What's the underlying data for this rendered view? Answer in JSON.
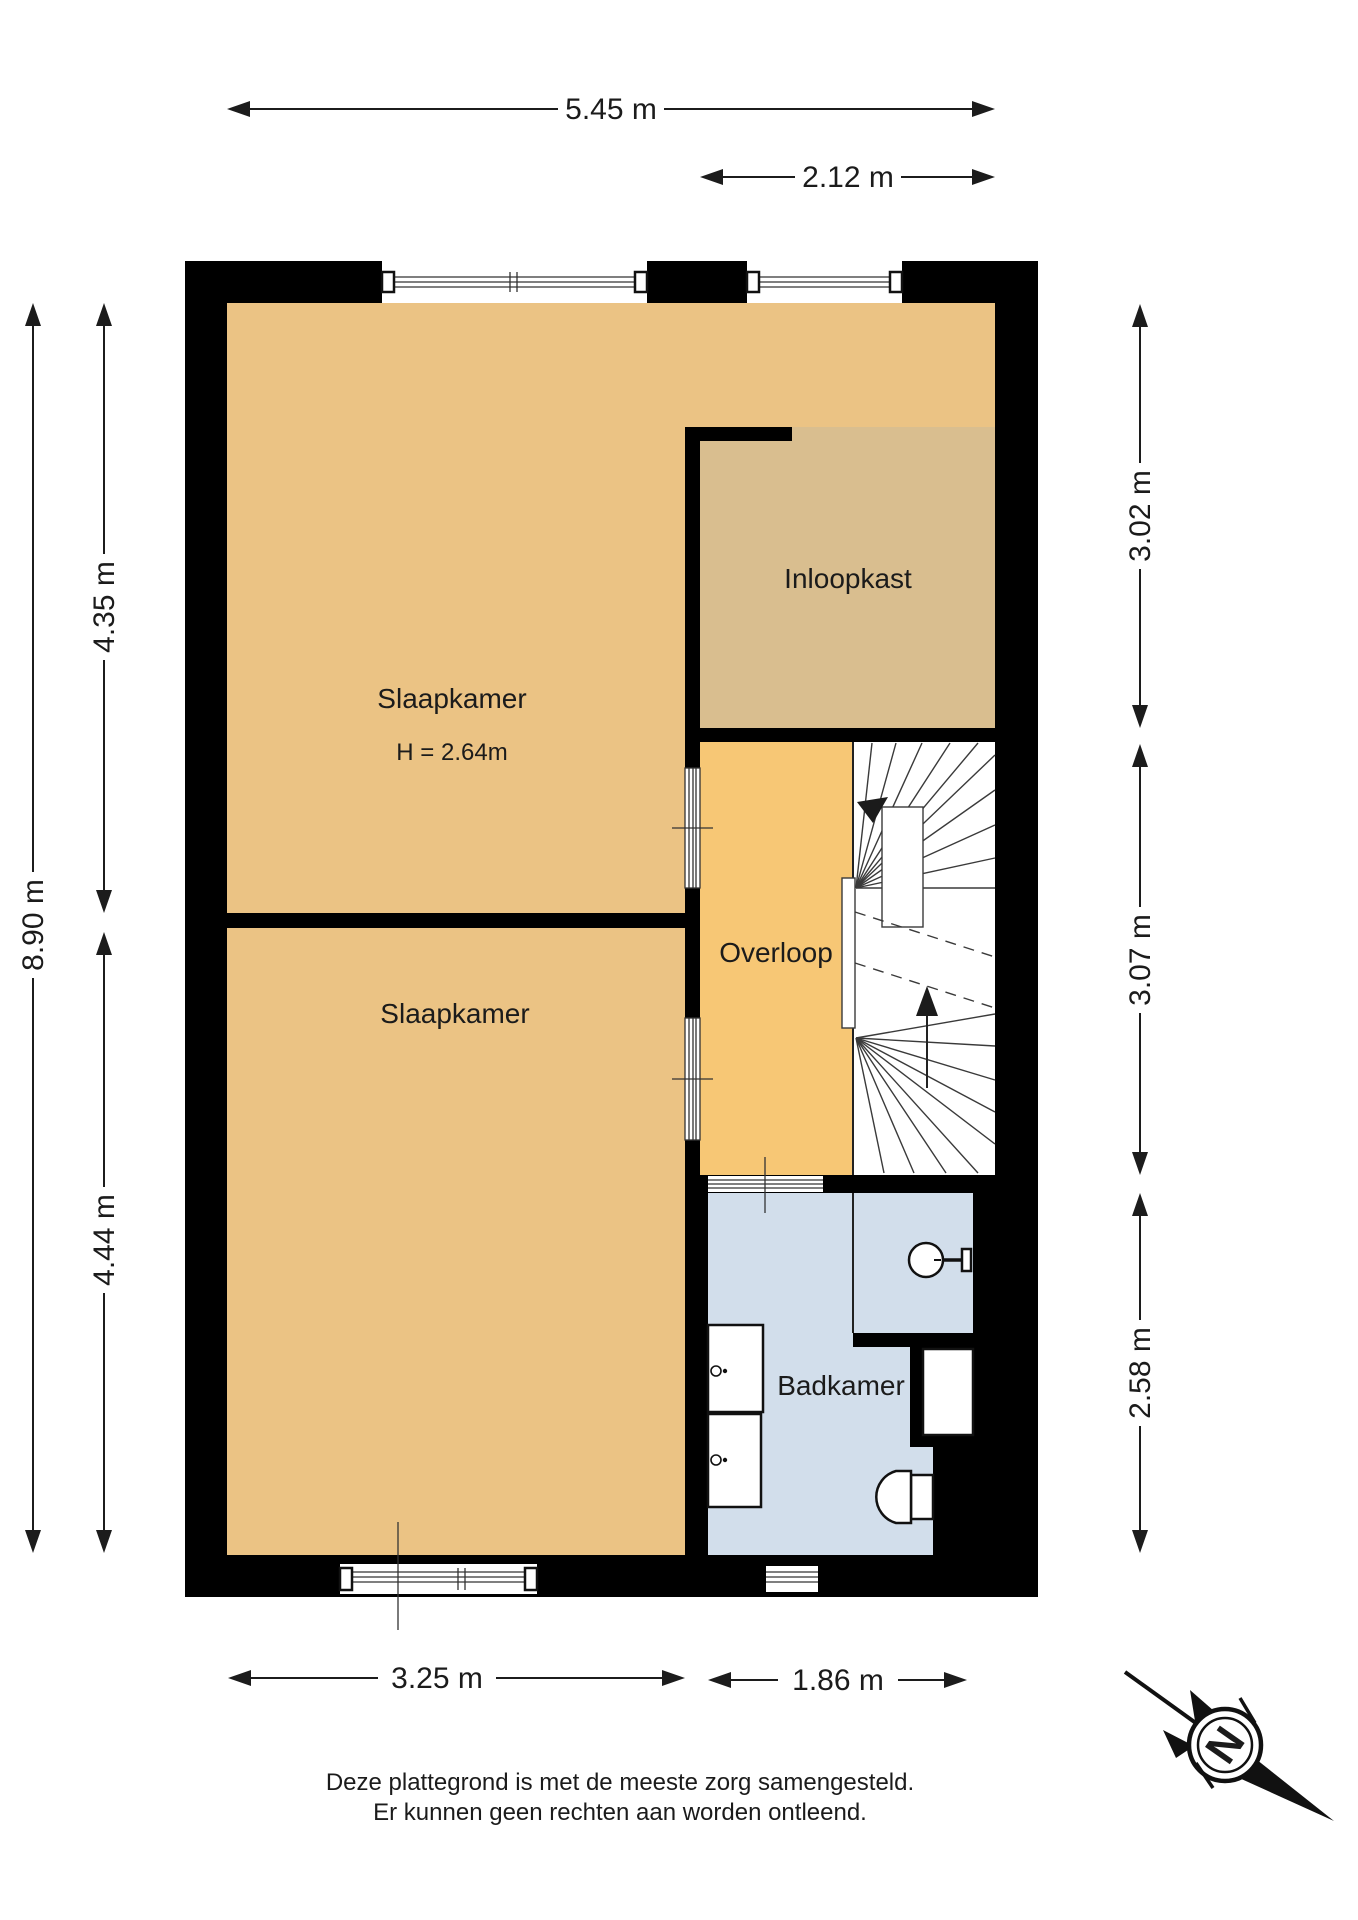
{
  "floorplan": {
    "rooms": {
      "slaapkamer_1": {
        "label": "Slaapkamer",
        "ceiling_height": "H = 2.64m",
        "color": "#ebc384"
      },
      "inloopkast": {
        "label": "Inloopkast",
        "color": "#d9be8f"
      },
      "overloop": {
        "label": "Overloop",
        "color": "#f7c775"
      },
      "slaapkamer_2": {
        "label": "Slaapkamer",
        "color": "#ebc384"
      },
      "badkamer": {
        "label": "Badkamer",
        "color": "#d2deeb"
      }
    },
    "colors": {
      "wall": "#000000",
      "background": "#ffffff"
    },
    "dimensions": {
      "top_total": "5.45 m",
      "top_right": "2.12 m",
      "left_total": "8.90 m",
      "left_upper": "4.35 m",
      "left_lower": "4.44 m",
      "right_upper": "3.02 m",
      "right_middle": "3.07 m",
      "right_lower": "2.58 m",
      "bottom_left": "3.25 m",
      "bottom_right": "1.86 m"
    },
    "compass": {
      "north_label": "N"
    },
    "icons": {
      "compass": "north-arrow-compass",
      "washbasin": "circle-basin-with-tap",
      "toilet": "toilet-with-cistern",
      "staircase": "winder-staircase-with-up-arrows",
      "appliances": "two-stacked-appliance-units"
    },
    "disclaimer": {
      "line1": "Deze plattegrond is met de meeste zorg samengesteld.",
      "line2": "Er kunnen geen rechten aan worden ontleend."
    }
  }
}
